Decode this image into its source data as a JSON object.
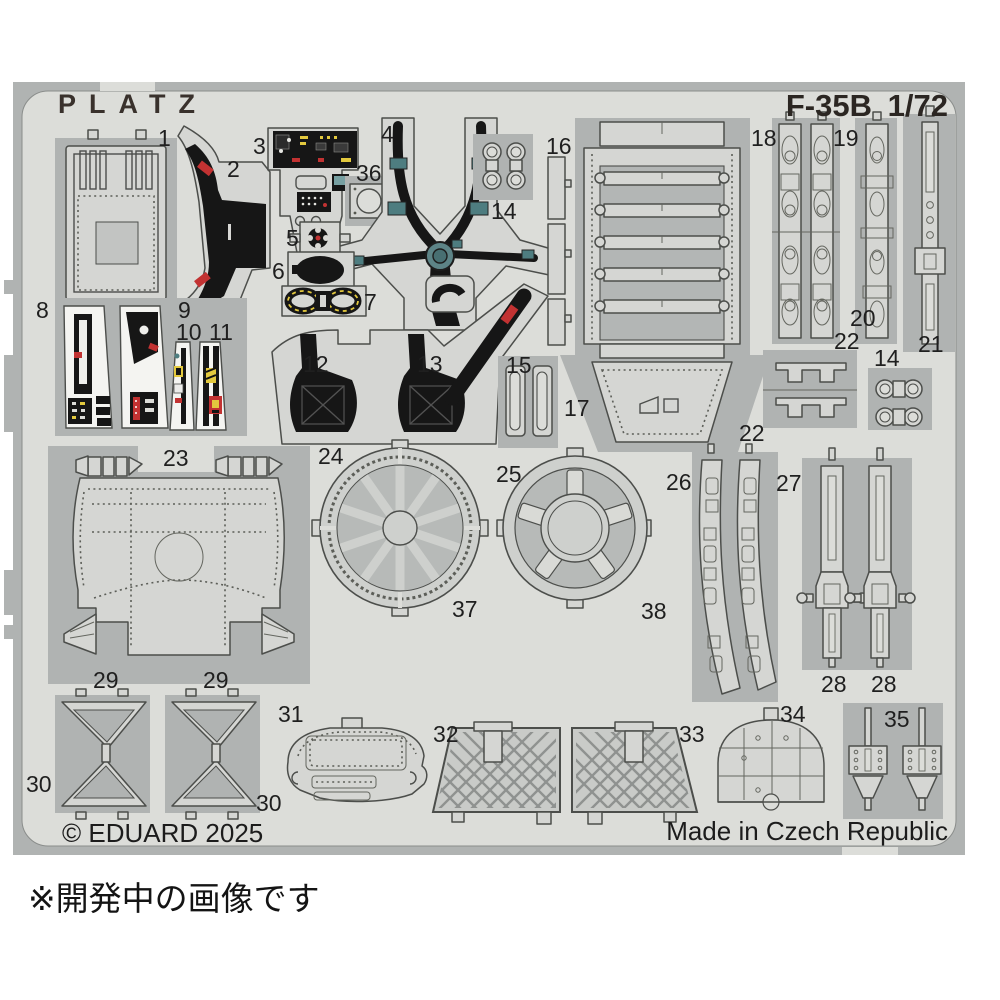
{
  "sheet": {
    "brand": "PLATZ",
    "model": "F-35B",
    "scale": "1/72",
    "copyright": "© EDUARD 2025",
    "origin": "Made in Czech Republic"
  },
  "caption": "※開発中の画像です",
  "labels": [
    "1",
    "2",
    "3",
    "36",
    "4",
    "5",
    "6",
    "7",
    "14",
    "16",
    "18",
    "19",
    "8",
    "9",
    "10",
    "11",
    "12",
    "13",
    "15",
    "17",
    "20",
    "22",
    "21",
    "22",
    "14",
    "23",
    "24",
    "25",
    "26",
    "27",
    "37",
    "38",
    "28",
    "28",
    "29",
    "29",
    "30",
    "30",
    "31",
    "32",
    "33",
    "34",
    "35"
  ],
  "colors": {
    "background": "#ffffff",
    "frame": "#b0b3b2",
    "field": "#dcddd9",
    "part": "#d5d6d3",
    "part2": "#c9cbc8",
    "inner": "#b3b6b5",
    "outline": "#4c4e4b",
    "black": "#161616",
    "white": "#f4f4f1",
    "red": "#c23232",
    "yellow": "#e3c93e",
    "teal": "#4e7d80",
    "ink": "#1f1f1f"
  }
}
